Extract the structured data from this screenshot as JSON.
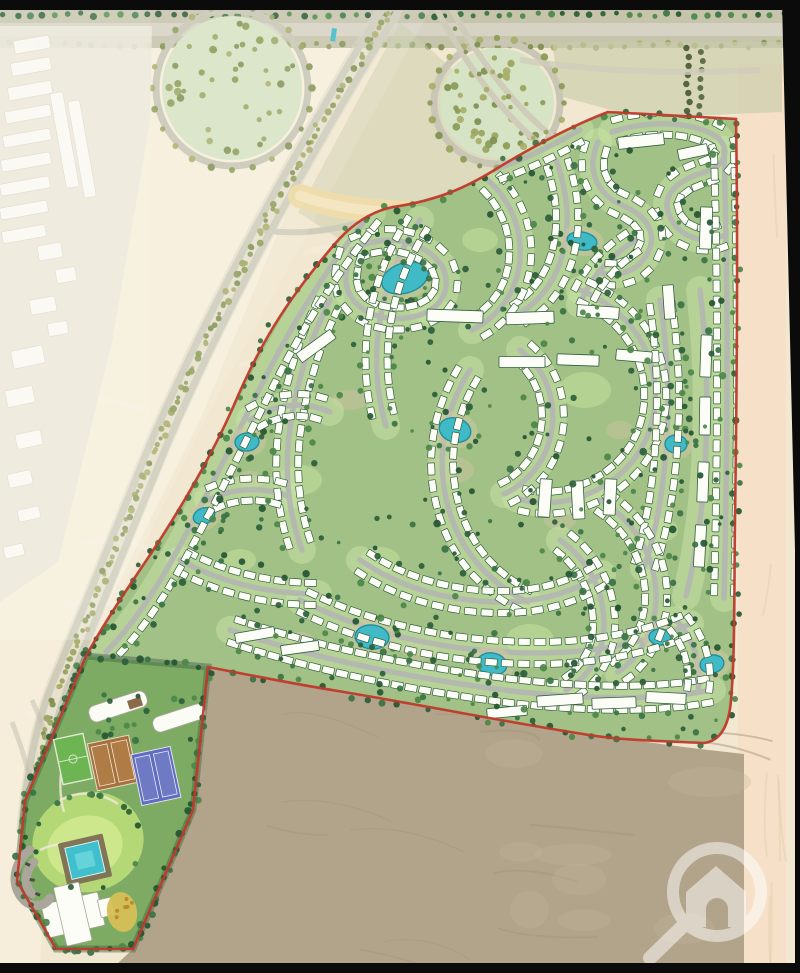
{
  "scene": {
    "width": 800,
    "height": 973,
    "description": "master-plan rendering of a desert residential compound"
  },
  "map": {
    "colors": {
      "black_frame": "#0b0b0b",
      "desert_base": "#f2e7d0",
      "desert_left": "#f6eeda",
      "desert_right_column": "#f6e0c8",
      "desert_dark_parcel": "#b2a48a",
      "dark_parcel_streak": "#a3957c",
      "sand_band": "#eedcab",
      "sand_band_core": "#f4e7c2",
      "park_fill": "#d6e3c4",
      "ring_road": "#c9c6b5",
      "scrub": "#c8cda9",
      "road_outside": "#cfccba",
      "road_inside": "#b4b9b0",
      "green_strip": "#c9e3a5",
      "compound_green": "#a2c186",
      "club_green": "#7dab63",
      "lawn": "#b5d877",
      "lawn_light": "#cfe98f",
      "lake_fill": "#3fbac6",
      "lake_stroke": "#1f8fa0",
      "lake_halo": "#cfc7a2",
      "villa_fill": "#fdfdf8",
      "villa_stroke": "#2f5f3b",
      "boundary_red": "#c0392b",
      "pitch_green": "#6cb552",
      "clay_court": "#a6713f",
      "blue_court": "#5f6cc0",
      "pool_deck": "#7d6f54",
      "pool_water": "#3fc0cc",
      "garden_yellow": "#d6bf55",
      "building_white": "#fcfcf6",
      "haze_white": "#ffffff",
      "watermark_white": "#ffffff",
      "tree_dark": [
        "#2d5e3a",
        "#3a7245",
        "#4c8749",
        "#245532"
      ],
      "tree_olive": [
        "#9aa45e",
        "#8a9a55",
        "#a8ae69",
        "#7f8f50"
      ]
    },
    "frame": {
      "top_bar": [
        0,
        0,
        800,
        10
      ],
      "bottom_bar": [
        0,
        963,
        800,
        10
      ],
      "right_wedge": "782,0 800,0 800,963 795,963 795,550"
    },
    "desert": {
      "left_poly": "0,10 390,10 300,180 200,420 110,600 60,700 40,963 0,963",
      "right_col": [
        738,
        64,
        48,
        899
      ],
      "scrub_poly": "552,42 782,42 782,112 640,118 560,96",
      "sand_band": "M300,196 C360,216 432,216 492,206 C540,198 574,176 602,150",
      "interchange_poly": "400,22 520,130 560,170 500,172 420,226 350,246 298,212"
    },
    "top_band": {
      "verge": [
        0,
        8,
        800,
        40
      ],
      "road": [
        0,
        23,
        800,
        13
      ]
    },
    "parks": [
      {
        "cx": 232,
        "cy": 88,
        "rx": 70,
        "ry": 72
      },
      {
        "cx": 497,
        "cy": 103,
        "rx": 57,
        "ry": 55
      }
    ],
    "landmark_marks": [
      [
        332,
        28,
        5,
        13,
        8
      ]
    ],
    "highways": {
      "avenue_lanes": [
        "M400,8 C348,92 308,162 270,232 C233,302 203,362 168,442 C138,517 103,602 70,682 C53,724 44,772 38,832",
        "M383,8 C331,92 291,162 253,232 C216,302 186,362 151,442 C121,517 86,602 53,682 C36,724 27,772 21,832"
      ],
      "avenue_center": "M391,8 C339,92 299,162 261,232 C224,302 194,362 159,442 C129,517 94,602 61,682 C44,724 35,772 29,832",
      "branch_lanes": [
        "M436,8 C460,54 490,98 528,134 C548,152 568,164 588,174",
        "M450,6 C474,50 502,92 540,126 C556,140 574,152 592,162"
      ],
      "park_link": "M262,230 C302,236 344,230 382,214",
      "top_right_road": "M520,60 C600,72 680,74 760,70",
      "sw_roads": [
        "M32,700 C60,760 70,830 60,900",
        "M12,722 C36,782 46,852 40,922"
      ]
    },
    "neighborhood": {
      "backdrop": "0,26 152,26 150,122 112,342 58,562 0,602",
      "buildings": [
        [
          14,
          38,
          36,
          13,
          -10
        ],
        [
          11,
          60,
          40,
          13,
          -10
        ],
        [
          8,
          84,
          44,
          13,
          -10
        ],
        [
          5,
          108,
          46,
          12,
          -10
        ],
        [
          3,
          132,
          48,
          12,
          -10
        ],
        [
          1,
          156,
          50,
          12,
          -10
        ],
        [
          0,
          180,
          50,
          12,
          -10
        ],
        [
          0,
          204,
          48,
          12,
          -10
        ],
        [
          2,
          228,
          44,
          12,
          -10
        ],
        [
          58,
          92,
          13,
          96,
          -10
        ],
        [
          76,
          100,
          12,
          98,
          -10
        ],
        [
          38,
          244,
          24,
          15,
          -10
        ],
        [
          56,
          268,
          20,
          14,
          -10
        ],
        [
          30,
          298,
          26,
          15,
          -10
        ],
        [
          48,
          322,
          20,
          13,
          -10
        ],
        [
          12,
          348,
          32,
          18,
          -12
        ],
        [
          6,
          388,
          28,
          17,
          -12
        ],
        [
          16,
          432,
          26,
          15,
          -12
        ],
        [
          8,
          472,
          24,
          14,
          -12
        ],
        [
          18,
          508,
          22,
          12,
          -12
        ],
        [
          4,
          545,
          20,
          12,
          -12
        ]
      ]
    },
    "haze_poly": "0,10 430,10 330,192 205,420 98,640 0,640",
    "dark_parcel": {
      "d": "M208,667 C300,684 390,700 470,713 C550,727 625,740 700,749 L744,754 L744,963 L118,963 L133,949 L193,810 Z"
    },
    "compound": {
      "outline": "M608,112 L736,119 C738,240 737,380 735,520 C734,600 735,655 731,700 C729,726 720,741 704,743 C658,741 624,740 596,736 C516,724 428,706 338,691 C288,683 240,673 208,667 L193,810 L133,949 L56,949 L17,881 L25,801 L86,656 C106,620 129,586 152,552 C186,500 216,448 237,398 C259,348 282,306 333,246 C353,222 373,211 393,207 C441,200 471,185 501,166 C531,148 571,126 608,112 Z",
      "villa": {
        "w": 12,
        "h": 7
      },
      "roads": [
        {
          "d": "M612,132 C648,120 690,121 716,136 C732,150 726,166 702,173 C676,181 660,196 670,217 C680,238 704,244 722,236",
          "villas": "both"
        },
        {
          "d": "M598,142 C586,168 596,194 622,205 C650,217 658,236 646,256 C636,272 616,278 598,272",
          "villas": "both"
        },
        {
          "d": "M556,160 C566,188 570,214 565,243 C560,272 546,296 522,312",
          "villas": "both"
        },
        {
          "d": "M488,180 C510,200 522,228 520,258 C518,290 500,316 472,330",
          "villas": "both"
        },
        {
          "d": "M352,250 C384,232 424,240 442,266 C454,290 440,314 406,318 C370,322 344,302 346,276 C347,264 349,256 352,250",
          "villas": "both"
        },
        {
          "d": "M420,220 C400,250 386,284 380,320 C374,356 376,392 386,426",
          "villas": "both"
        },
        {
          "d": "M330,300 C310,340 296,384 290,428 C284,470 288,512 302,550",
          "villas": "both"
        },
        {
          "d": "M250,420 C274,404 304,400 330,412",
          "villas": "both"
        },
        {
          "d": "M208,500 C232,488 262,486 288,496",
          "villas": "both"
        },
        {
          "d": "M180,560 C220,582 268,594 318,594",
          "villas": "both"
        },
        {
          "d": "M580,290 C620,306 648,338 654,378 C660,420 644,458 610,482 C580,502 546,508 516,498",
          "villas": "both"
        },
        {
          "d": "M520,350 C544,368 556,396 552,428 C548,458 530,482 504,494",
          "villas": "both"
        },
        {
          "d": "M470,370 C446,408 436,452 446,498 C456,546 486,582 528,602",
          "villas": "both"
        },
        {
          "d": "M700,290 C706,340 708,392 706,444 C704,498 698,548 686,596",
          "villas": "none"
        },
        {
          "d": "M660,300 C668,350 670,400 666,450 C663,492 656,532 644,568",
          "villas": "both"
        },
        {
          "d": "M600,500 C632,520 654,552 656,592 C657,624 644,654 618,672",
          "villas": "both"
        },
        {
          "d": "M560,540 C588,560 604,590 604,624 C604,652 590,676 566,690",
          "villas": "both"
        },
        {
          "d": "M360,560 C400,588 450,602 502,602 C540,602 574,592 602,574",
          "villas": "both"
        },
        {
          "d": "M300,600 C360,630 430,648 504,652 C570,656 634,648 690,624",
          "villas": "both"
        },
        {
          "d": "M230,630 C320,660 420,680 520,692 C600,700 660,700 712,690",
          "villas": "both",
          "off": 12,
          "spacing": 14
        },
        {
          "d": "M676,620 C694,640 702,664 698,692",
          "villas": "both"
        },
        {
          "d": "M372,212 C334,258 298,314 268,372 C234,440 202,506 172,560 C152,596 130,628 106,652",
          "villas": "right"
        },
        {
          "d": "M580,130 C552,146 522,160 494,170",
          "villas": "both"
        },
        {
          "d": "M636,240 C610,256 590,278 580,304",
          "villas": "both"
        },
        {
          "d": "M724,150 C728,290 728,440 724,598",
          "villas": "both",
          "off": 10
        }
      ],
      "bars": [
        [
          455,
          316,
          56,
          12,
          2
        ],
        [
          530,
          318,
          48,
          12,
          -2
        ],
        [
          598,
          312,
          42,
          12,
          4
        ],
        [
          522,
          362,
          46,
          11,
          0
        ],
        [
          578,
          360,
          42,
          11,
          2
        ],
        [
          634,
          356,
          36,
          11,
          5
        ],
        [
          641,
          141,
          46,
          12,
          -6
        ],
        [
          693,
          152,
          30,
          11,
          -12
        ],
        [
          706,
          228,
          12,
          42,
          2
        ],
        [
          432,
          152,
          42,
          11,
          -18
        ],
        [
          398,
          170,
          40,
          11,
          -24
        ],
        [
          560,
          700,
          46,
          11,
          -4
        ],
        [
          614,
          703,
          44,
          11,
          -2
        ],
        [
          666,
          698,
          40,
          11,
          3
        ],
        [
          507,
          712,
          40,
          10,
          -5
        ],
        [
          316,
          346,
          42,
          11,
          -36
        ],
        [
          545,
          498,
          12,
          38,
          4
        ],
        [
          578,
          500,
          12,
          38,
          -3
        ],
        [
          610,
          497,
          12,
          36,
          3
        ],
        [
          706,
          356,
          11,
          42,
          2
        ],
        [
          705,
          416,
          11,
          38,
          1
        ],
        [
          703,
          482,
          11,
          40,
          2
        ],
        [
          700,
          546,
          11,
          42,
          3
        ],
        [
          669,
          302,
          11,
          34,
          -4
        ],
        [
          255,
          635,
          40,
          10,
          -10
        ],
        [
          300,
          648,
          38,
          10,
          -8
        ]
      ],
      "lakes": [
        [
          405,
          278,
          24,
          15,
          -18
        ],
        [
          582,
          241,
          15,
          9,
          10
        ],
        [
          247,
          442,
          12,
          9,
          -5
        ],
        [
          455,
          430,
          16,
          12,
          15
        ],
        [
          676,
          444,
          11,
          9,
          0
        ],
        [
          204,
          516,
          11,
          8,
          -20
        ],
        [
          372,
          637,
          17,
          12,
          5
        ],
        [
          492,
          664,
          15,
          11,
          10
        ],
        [
          660,
          637,
          11,
          8,
          0
        ],
        [
          712,
          664,
          12,
          9,
          -10
        ]
      ],
      "green_patches": [
        [
          585,
          390,
          26,
          18
        ],
        [
          430,
          310,
          20,
          14
        ],
        [
          300,
          480,
          22,
          15
        ],
        [
          530,
          640,
          24,
          16
        ],
        [
          660,
          530,
          18,
          12
        ],
        [
          380,
          560,
          20,
          13
        ],
        [
          240,
          560,
          16,
          11
        ],
        [
          480,
          240,
          18,
          12
        ]
      ],
      "khaki_patches": [
        [
          450,
          470,
          24,
          14
        ],
        [
          350,
          400,
          18,
          10
        ],
        [
          560,
          520,
          16,
          10
        ],
        [
          250,
          480,
          14,
          9
        ],
        [
          620,
          430,
          14,
          9
        ],
        [
          420,
          650,
          18,
          10
        ],
        [
          300,
          640,
          14,
          8
        ]
      ]
    },
    "parking": {
      "pts": "90,654 206,665 202,706 87,700",
      "lanes": [
        "M92,662 L200,668",
        "M90,676 L200,682",
        "M88,690 L200,696"
      ]
    },
    "club": {
      "pts": "86,656 208,667 193,810 133,949 56,949 17,881 25,801",
      "lawn": {
        "cx": 88,
        "cy": 842,
        "rx": 56,
        "ry": 50,
        "rot": -15
      },
      "lawn_inner": {
        "cx": 85,
        "cy": 847,
        "rx": 38,
        "ry": 31,
        "rot": -15
      },
      "pitch": {
        "x": 58,
        "y": 736,
        "w": 30,
        "h": 46,
        "rot": -12
      },
      "clay": {
        "x": 92,
        "y": 739,
        "w": 42,
        "h": 48,
        "rot": -12
      },
      "blue": {
        "x": 136,
        "y": 750,
        "w": 40,
        "h": 52,
        "rot": -12
      },
      "pool": {
        "deck": [
          62,
          838,
          46,
          44
        ],
        "water": [
          68,
          844,
          34,
          32
        ],
        "step": [
          76,
          852,
          18,
          16
        ],
        "rot": -13
      },
      "house": {
        "base": [
          44,
          898,
          58,
          34
        ],
        "wing": [
          60,
          884,
          26,
          60
        ],
        "ext": [
          100,
          906,
          14,
          18
        ],
        "rot": -13
      },
      "garden": {
        "cx": 122,
        "cy": 912,
        "rx": 15,
        "ry": 20,
        "rot": -10
      },
      "buildings": [
        {
          "x": 88,
          "y": 698,
          "w": 60,
          "h": 17,
          "rot": -18
        },
        {
          "x": 152,
          "y": 710,
          "w": 54,
          "h": 16,
          "rot": -18
        }
      ],
      "bridge": [
        127,
        701,
        14,
        9,
        -18
      ],
      "loops": [
        "M30,850 C14,862 10,884 22,898 C30,908 44,908 50,898",
        "M34,862 C24,872 24,886 32,894"
      ],
      "walkways": [
        "M60,800 C80,790 100,792 118,804",
        "M40,850 C60,840 84,842 104,856",
        "M66,744 C60,770 58,792 64,812"
      ]
    },
    "boundary": {
      "width": 2.6
    },
    "watermark": {
      "cx": 717,
      "cy": 892,
      "r": 44,
      "ring_width": 12,
      "opacity": 0.5,
      "house_d": "M716,866 L746,892 L746,927 L686,927 L686,892 Z M706,927 L706,909 A11,11 0 0 1 728,909 L728,927 Z",
      "handle": [
        684,
        925,
        650,
        958
      ],
      "handle_width": 14
    }
  }
}
